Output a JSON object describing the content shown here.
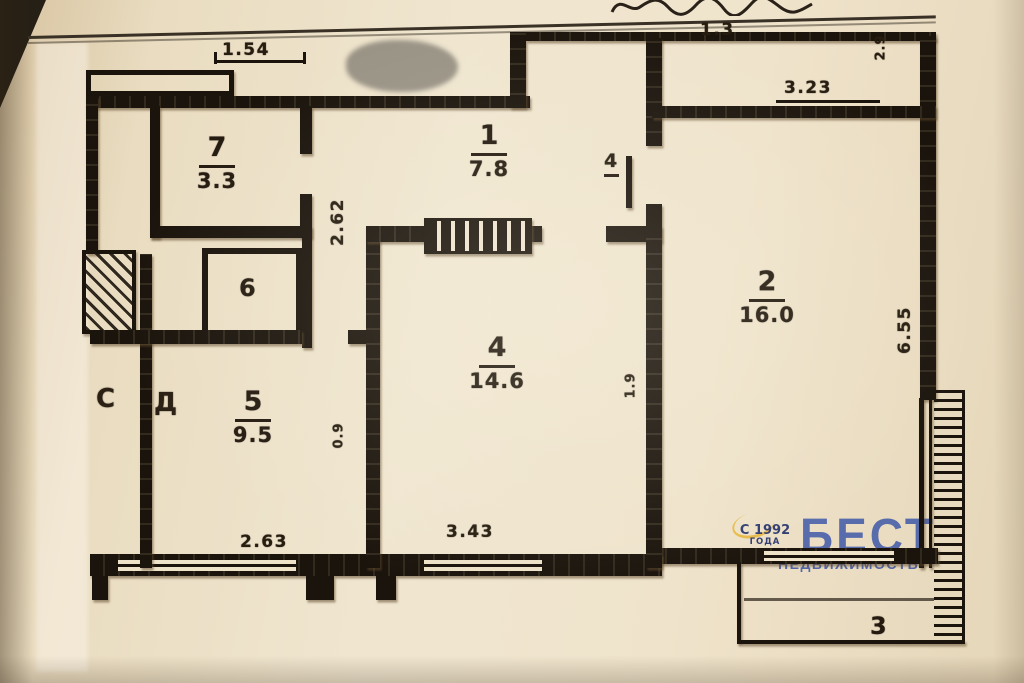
{
  "rooms": [
    {
      "number": "1",
      "area": "7.8"
    },
    {
      "number": "2",
      "area": "16.0"
    },
    {
      "number": "3",
      "area": ""
    },
    {
      "number": "4",
      "area": "14.6"
    },
    {
      "number": "5",
      "area": "9.5"
    },
    {
      "number": "6",
      "area": ""
    },
    {
      "number": "7",
      "area": "3.3"
    }
  ],
  "dims": [
    "1.54",
    "1.3",
    "3.23",
    "2.62",
    "4",
    "0.9",
    "1.9",
    "2.63",
    "3.43",
    "6.55",
    "2.9"
  ],
  "labels": {
    "closet_left": "С",
    "closet_right": "Д"
  },
  "watermark": {
    "since_top": "С 1992",
    "since_bottom": "ГОДА",
    "brand": "БЕСТ",
    "subtitle": "НЕДВИЖИМОСТЬ"
  },
  "colors": {
    "wall": "#1b140c",
    "paper": "#ecdfc4",
    "brand_blue": "#3f58a8",
    "accent_yellow": "#e8b73c",
    "since_navy": "#23306b"
  }
}
